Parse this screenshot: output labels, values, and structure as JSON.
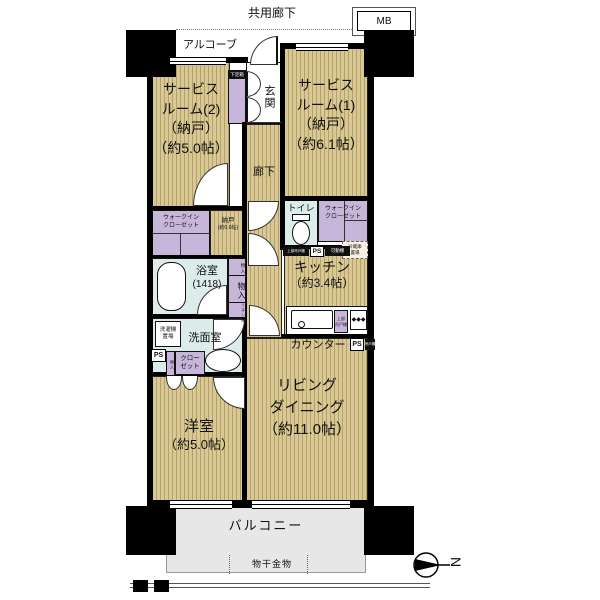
{
  "t": {
    "common_corridor": "共用廊下",
    "mb": "MB",
    "alcove": "アルコーブ",
    "genkan": "玄関",
    "shoe_box": "下足箱",
    "sr2_1": "サービス",
    "sr2_2": "ルーム(2)",
    "sr2_3": "（納戸）",
    "sr2_4": "（約5.0帖）",
    "sr1_1": "サービス",
    "sr1_2": "ルーム(1)",
    "sr1_3": "（納戸）",
    "sr1_4": "（約6.1帖）",
    "corridor": "廊下",
    "toilet": "トイレ",
    "wic_1": "ウォークイン",
    "wic_2": "クローゼット",
    "ps": "PS",
    "movable_shelf": "可動棚",
    "toilet_cabinet": "上部吊戸棚",
    "fridge_1": "冷蔵庫",
    "fridge_2": "置場",
    "kitchen_1": "キッチン",
    "kitchen_2": "（約3.4帖）",
    "kitchen_cabinet_1": "上部",
    "kitchen_cabinet_2": "吊戸棚",
    "counter": "カウンター",
    "counter_end": "吊戸棚",
    "nando_1": "納戸",
    "nando_2": "(約0.6帖)",
    "bath_1": "浴室",
    "bath_2": "(1418)",
    "monoire": "物入",
    "linen": "リネン庫",
    "washer_1": "洗濯機",
    "washer_2": "置場",
    "washroom": "洗面室",
    "closet_1": "クロー",
    "closet_2": "ゼット",
    "yoshitsu_1": "洋室",
    "yoshitsu_2": "（約5.0帖）",
    "ld_1": "リビング",
    "ld_2": "ダイニング",
    "ld_3": "（約11.0帖）",
    "balcony": "バルコニー",
    "laundry": "物干金物",
    "north": "N",
    "burner": "◆"
  },
  "colors": {
    "floor": "#d9c893",
    "closet": "#c7b6da",
    "wet": "#dcecea",
    "balcony_color": "#e7e7e7",
    "wall": "#000000"
  }
}
